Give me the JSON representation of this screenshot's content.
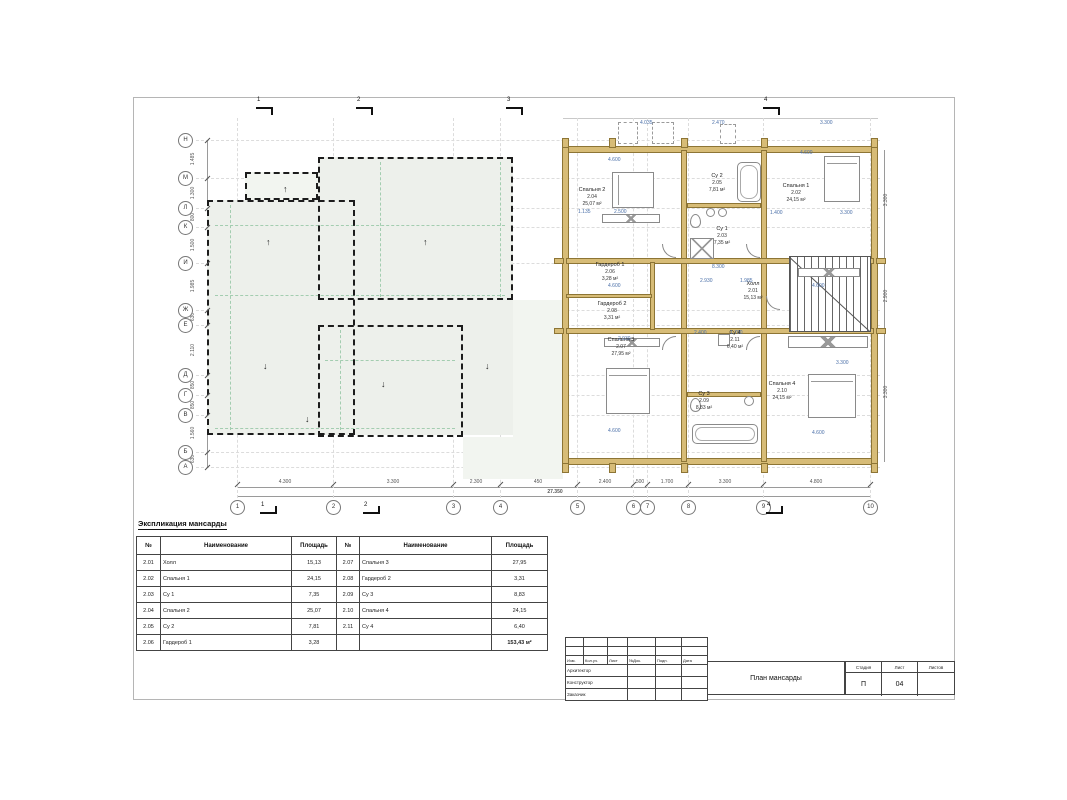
{
  "sheet": {
    "explication_title": "Экспликация мансарды"
  },
  "explication": {
    "headers": [
      "№",
      "Наименование",
      "Площадь"
    ],
    "left_rows": [
      [
        "2.01",
        "Холл",
        "15,13"
      ],
      [
        "2.02",
        "Спальня 1",
        "24,15"
      ],
      [
        "2.03",
        "Су 1",
        "7,35"
      ],
      [
        "2.04",
        "Спальня 2",
        "25,07"
      ],
      [
        "2.05",
        "Су 2",
        "7,81"
      ],
      [
        "2.06",
        "Гардероб 1",
        "3,28"
      ]
    ],
    "right_rows": [
      [
        "2.07",
        "Спальня 3",
        "27,95"
      ],
      [
        "2.08",
        "Гардероб 2",
        "3,31"
      ],
      [
        "2.09",
        "Су 3",
        "8,83"
      ],
      [
        "2.10",
        "Спальня 4",
        "24,15"
      ],
      [
        "2.11",
        "Су 4",
        "6,40"
      ]
    ],
    "total": "153,43 м²"
  },
  "title_block": {
    "header_cells": [
      "Изм.",
      "Кол.уч.",
      "Лист",
      "№Док.",
      "Подп.",
      "Дата"
    ],
    "role_rows": [
      "Архитектор",
      "Конструктор",
      "Заказчик"
    ],
    "drawing_title": "План мансарды",
    "stage_label": "Стадия",
    "sheet_label": "Лист",
    "sheets_label": "Листов",
    "stage_value": "П",
    "sheet_value": "04",
    "sheets_value": ""
  },
  "plan": {
    "rooms": [
      {
        "name": "Холл",
        "number": "2.01",
        "area": "15,13 м²",
        "x": 753,
        "y": 291
      },
      {
        "name": "Спальня 1",
        "number": "2.02",
        "area": "24,15 м²",
        "x": 796,
        "y": 193
      },
      {
        "name": "Су 1",
        "number": "2.03",
        "area": "7,35 м²",
        "x": 722,
        "y": 236
      },
      {
        "name": "Спальня 2",
        "number": "2.04",
        "area": "25,07 м²",
        "x": 592,
        "y": 197
      },
      {
        "name": "Су 2",
        "number": "2.05",
        "area": "7,81 м²",
        "x": 717,
        "y": 183
      },
      {
        "name": "Гардероб 1",
        "number": "2.06",
        "area": "3,28 м²",
        "x": 610,
        "y": 272
      },
      {
        "name": "Спальня 3",
        "number": "2.07",
        "area": "27,95 м²",
        "x": 621,
        "y": 347
      },
      {
        "name": "Гардероб 2",
        "number": "2.08",
        "area": "3,31 м²",
        "x": 612,
        "y": 311
      },
      {
        "name": "Су 3",
        "number": "2.09",
        "area": "8,83 м²",
        "x": 704,
        "y": 401
      },
      {
        "name": "Спальня 4",
        "number": "2.10",
        "area": "24,15 м²",
        "x": 782,
        "y": 391
      },
      {
        "name": "Су 4",
        "number": "2.11",
        "area": "6,40 м²",
        "x": 735,
        "y": 340
      }
    ],
    "axes_bottom": [
      {
        "label": "1",
        "x": 237
      },
      {
        "label": "2",
        "x": 333
      },
      {
        "label": "3",
        "x": 453
      },
      {
        "label": "4",
        "x": 500
      },
      {
        "label": "5",
        "x": 577
      },
      {
        "label": "6",
        "x": 633
      },
      {
        "label": "7",
        "x": 647
      },
      {
        "label": "8",
        "x": 688
      },
      {
        "label": "9",
        "x": 763
      },
      {
        "label": "10",
        "x": 870
      }
    ],
    "axes_left": [
      {
        "label": "Н",
        "y": 140
      },
      {
        "label": "М",
        "y": 178
      },
      {
        "label": "Л",
        "y": 208
      },
      {
        "label": "К",
        "y": 227
      },
      {
        "label": "И",
        "y": 263
      },
      {
        "label": "Ж",
        "y": 310
      },
      {
        "label": "Е",
        "y": 325
      },
      {
        "label": "Д",
        "y": 375
      },
      {
        "label": "Г",
        "y": 395
      },
      {
        "label": "В",
        "y": 415
      },
      {
        "label": "Б",
        "y": 452
      },
      {
        "label": "А",
        "y": 467
      }
    ],
    "dim_segments_bottom": [
      {
        "text": "4.300",
        "x": 285
      },
      {
        "text": "3.300",
        "x": 393
      },
      {
        "text": "2.300",
        "x": 476
      },
      {
        "text": "450",
        "x": 538
      },
      {
        "text": "2.400",
        "x": 605
      },
      {
        "text": "500",
        "x": 640
      },
      {
        "text": "1.700",
        "x": 667
      },
      {
        "text": "3.300",
        "x": 725
      },
      {
        "text": "4.800",
        "x": 816
      }
    ],
    "dim_total_bottom": "27.350",
    "dim_segments_left": [
      {
        "text": "1.485",
        "y": 159
      },
      {
        "text": "1.300",
        "y": 193
      },
      {
        "text": "800",
        "y": 217
      },
      {
        "text": "1.500",
        "y": 245
      },
      {
        "text": "1.985",
        "y": 286
      },
      {
        "text": "630",
        "y": 317
      },
      {
        "text": "2.110",
        "y": 350
      },
      {
        "text": "850",
        "y": 385
      },
      {
        "text": "850",
        "y": 405
      },
      {
        "text": "1.560",
        "y": 433
      },
      {
        "text": "630",
        "y": 459
      }
    ],
    "dim_segments_right": [
      {
        "text": "3.300",
        "y": 200
      },
      {
        "text": "2.900",
        "y": 296
      },
      {
        "text": "3.300",
        "y": 392
      }
    ],
    "blue_dims": [
      {
        "text": "4.600",
        "x": 608,
        "y": 157
      },
      {
        "text": "2.500",
        "x": 614,
        "y": 209
      },
      {
        "text": "1.135",
        "x": 578,
        "y": 209
      },
      {
        "text": "4.600",
        "x": 800,
        "y": 150
      },
      {
        "text": "3.300",
        "x": 840,
        "y": 210
      },
      {
        "text": "1.400",
        "x": 770,
        "y": 210
      },
      {
        "text": "8.300",
        "x": 712,
        "y": 264
      },
      {
        "text": "2.930",
        "x": 700,
        "y": 278
      },
      {
        "text": "1.985",
        "x": 740,
        "y": 278
      },
      {
        "text": "2.930",
        "x": 618,
        "y": 336
      },
      {
        "text": "4.600",
        "x": 608,
        "y": 283
      },
      {
        "text": "4.600",
        "x": 812,
        "y": 283
      },
      {
        "text": "3.300",
        "x": 836,
        "y": 360
      },
      {
        "text": "4.600",
        "x": 608,
        "y": 428
      },
      {
        "text": "4.600",
        "x": 812,
        "y": 430
      },
      {
        "text": "2.400",
        "x": 694,
        "y": 330
      },
      {
        "text": "1.700",
        "x": 730,
        "y": 330
      },
      {
        "text": "4.035",
        "x": 640,
        "y": 120
      },
      {
        "text": "2.470",
        "x": 712,
        "y": 120
      },
      {
        "text": "3.300",
        "x": 820,
        "y": 120
      }
    ],
    "slope_arrows": [
      {
        "dir": "up",
        "x": 283,
        "y": 185
      },
      {
        "dir": "up",
        "x": 266,
        "y": 238
      },
      {
        "dir": "up",
        "x": 423,
        "y": 238
      },
      {
        "dir": "down",
        "x": 263,
        "y": 362
      },
      {
        "dir": "down",
        "x": 381,
        "y": 380
      },
      {
        "dir": "down",
        "x": 485,
        "y": 362
      },
      {
        "dir": "down",
        "x": 305,
        "y": 415
      }
    ],
    "section_marks_top": [
      {
        "label": "1",
        "x": 256
      },
      {
        "label": "2",
        "x": 356
      },
      {
        "label": "3",
        "x": 506
      },
      {
        "label": "4",
        "x": 763
      }
    ],
    "section_marks_bottom": [
      {
        "label": "1",
        "x": 260
      },
      {
        "label": "2",
        "x": 363
      },
      {
        "label": "4",
        "x": 766
      }
    ]
  },
  "colors": {
    "wall": "#d7bc77",
    "wall_border": "#8d7535",
    "roof_fill": "#edf0eb",
    "green_dash": "#a3cdb0",
    "dim_blue": "#4a6fa8"
  }
}
